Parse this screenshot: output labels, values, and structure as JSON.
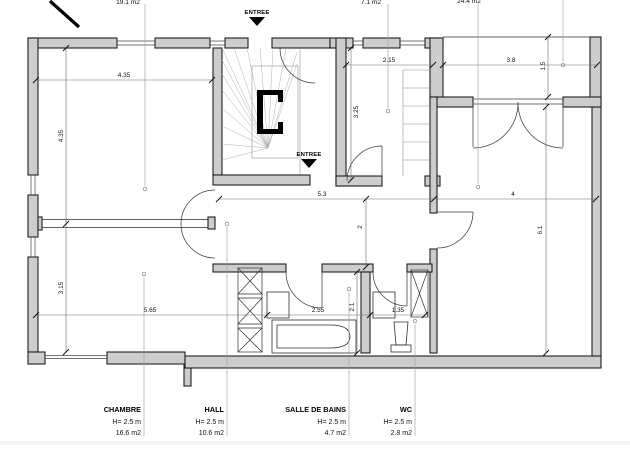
{
  "entrance_label": "ENTREE",
  "top_area_labels": {
    "room_top_left": "19.1 m2",
    "room_top_middle": "7.1 m2",
    "room_right": "24.4 m2"
  },
  "room_labels": {
    "chambre": {
      "name": "CHAMBRE",
      "height": "H= 2.5 m",
      "area": "16.6 m2"
    },
    "hall": {
      "name": "HALL",
      "height": "H= 2.5 m",
      "area": "10.6 m2"
    },
    "sdb": {
      "name": "SALLE DE BAINS",
      "height": "H= 2.5 m",
      "area": "4.7 m2"
    },
    "wc": {
      "name": "WC",
      "height": "H= 2.5 m",
      "area": "2.8 m2"
    }
  },
  "dimensions": {
    "room_tl_width": "4.35",
    "room_tl_height": "4.35",
    "chambre_height": "3.15",
    "chambre_width": "5.65",
    "bath_width": "2.55",
    "bath_height": "2.1",
    "wc_width": "1.35",
    "mid_room_width": "2.15",
    "mid_room_height": "3.25",
    "terrace_width": "3.8",
    "terrace_height": "1.5",
    "hall_width": "5.3",
    "big_room_width": "4",
    "hall_height": "2",
    "big_room_height": "6.1"
  },
  "colors": {
    "wall_fill": "#cdcdcd",
    "line": "#1f1f1f"
  }
}
